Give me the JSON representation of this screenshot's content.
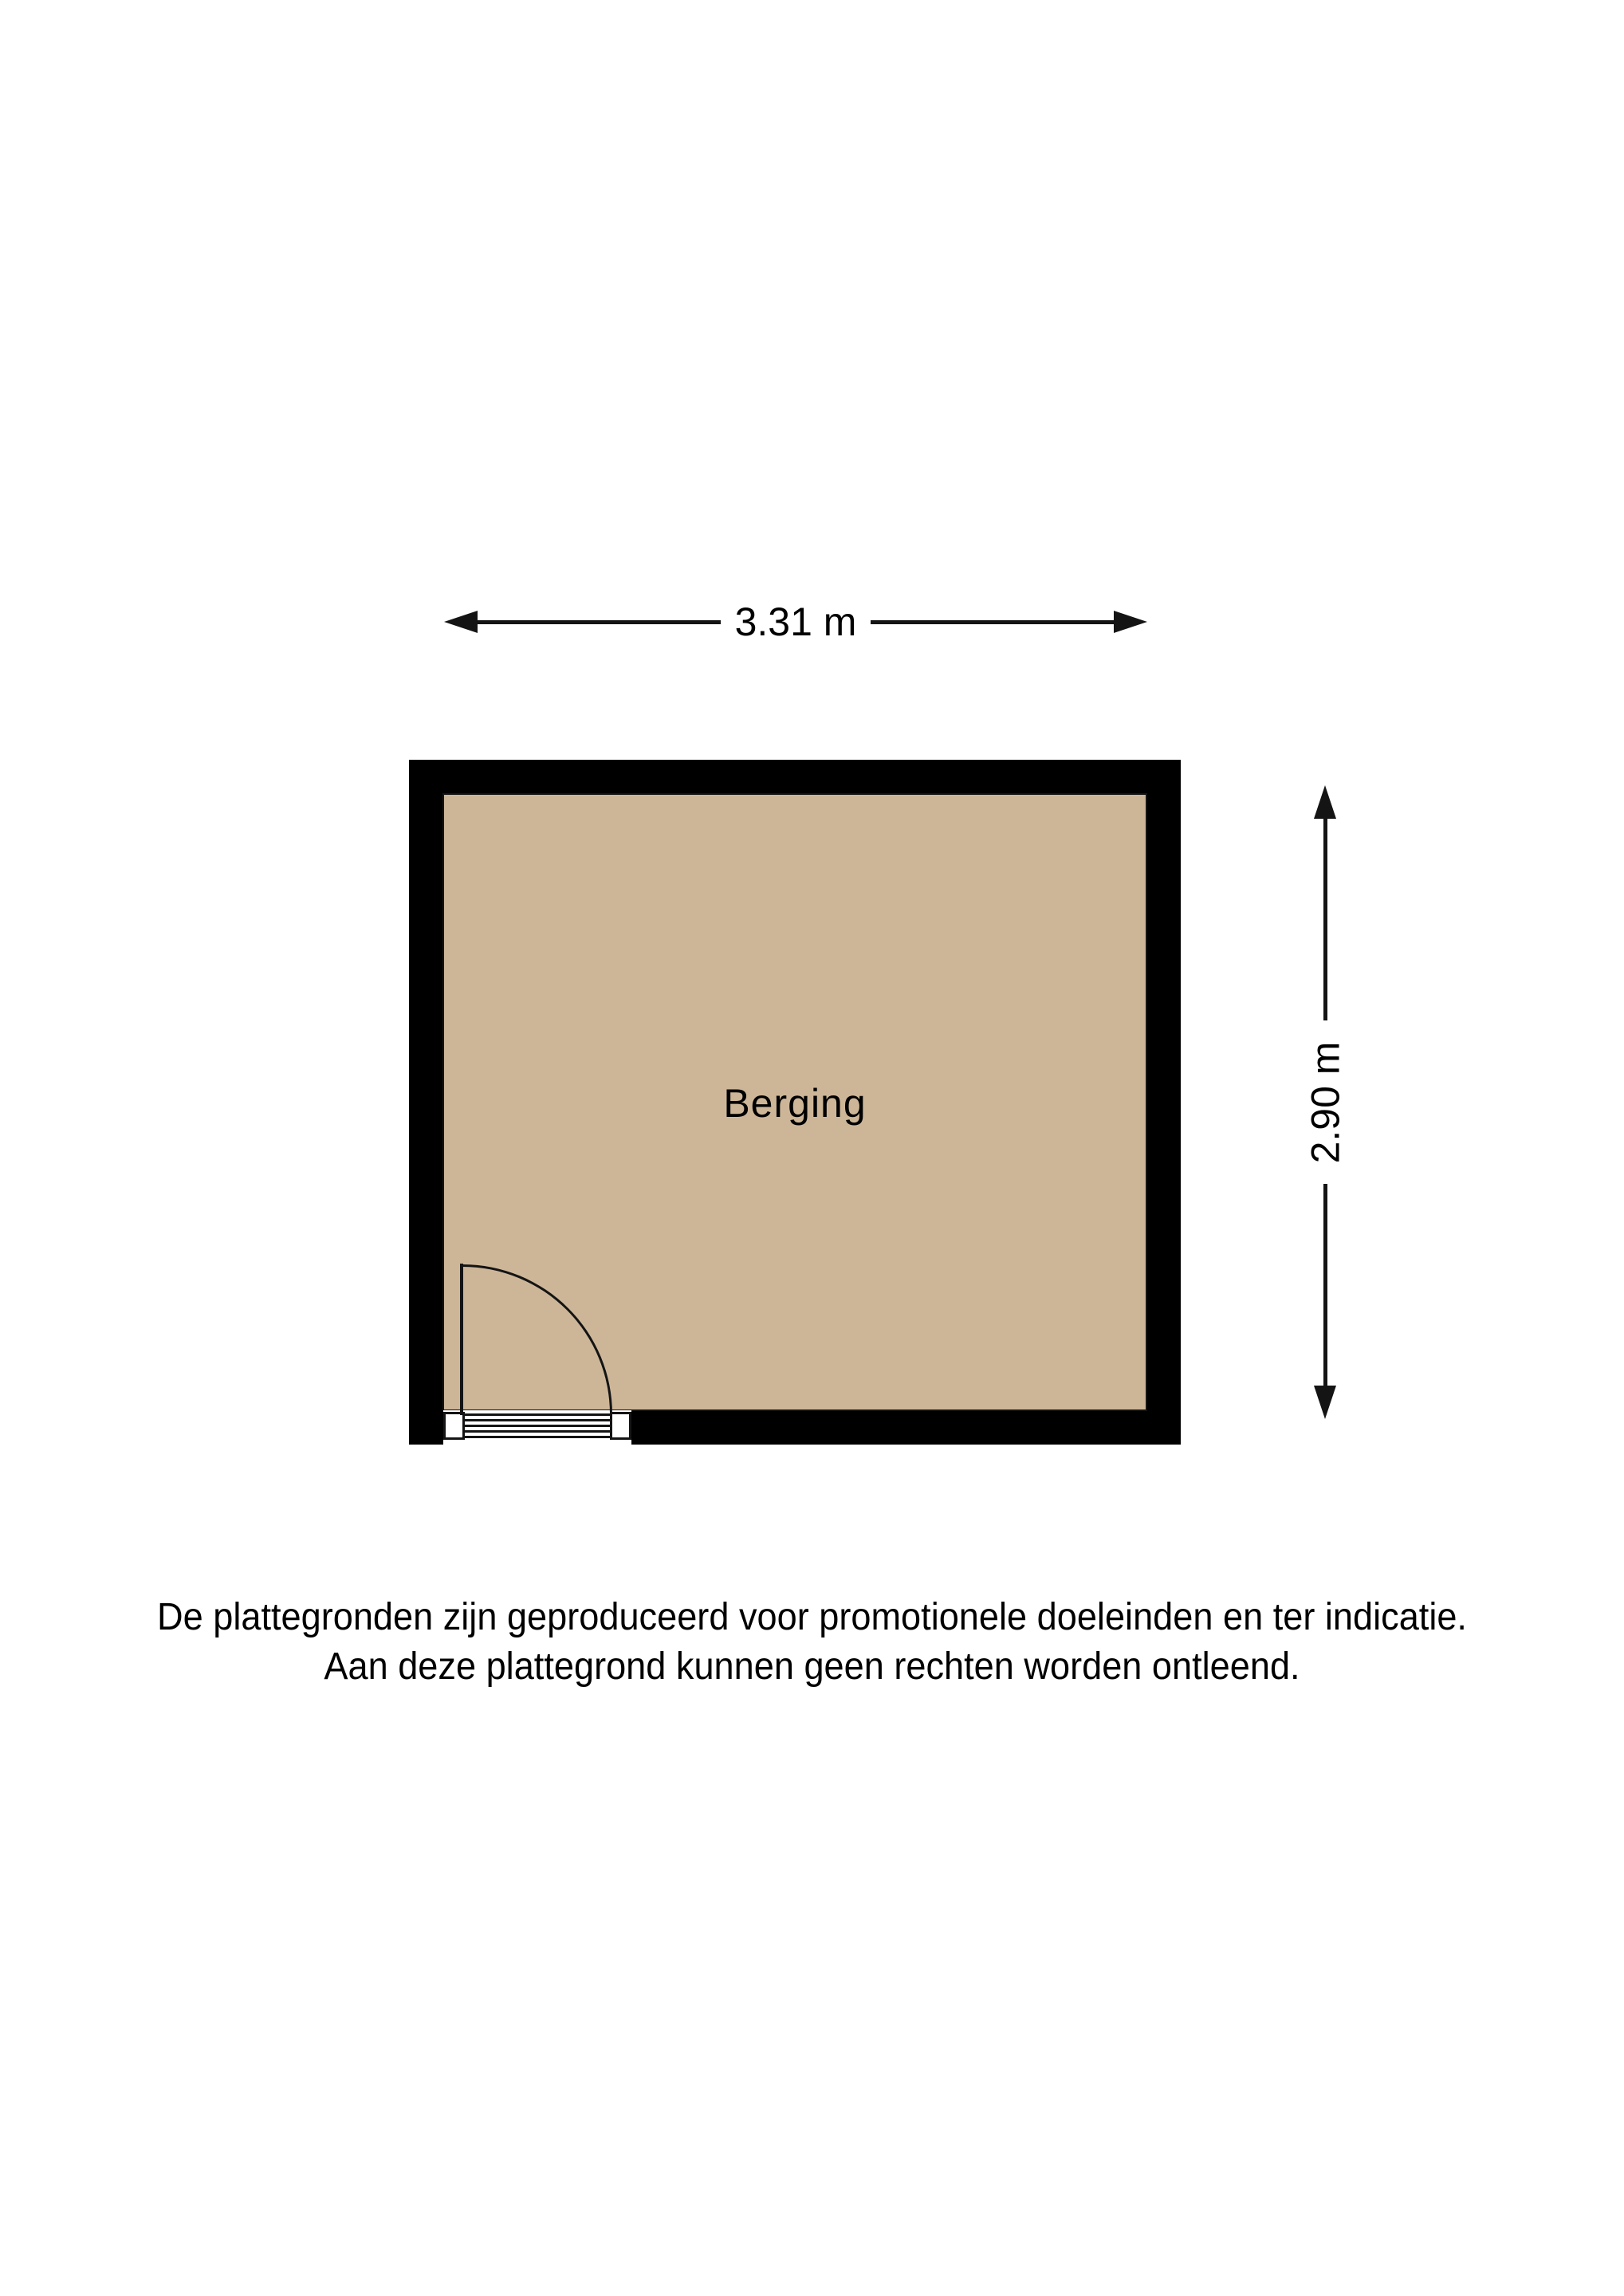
{
  "floorplan": {
    "room": {
      "label": "Berging"
    },
    "dimensions": {
      "width_label": "3.31 m",
      "height_label": "2.90 m"
    },
    "disclaimer": {
      "line1": "De plattegronden zijn geproduceerd voor promotionele doeleinden en ter indicatie.",
      "line2": "Aan deze plattegrond kunnen geen rechten worden ontleend."
    },
    "colors": {
      "wall": "#000000",
      "floor": "#cdb698",
      "line": "#141414",
      "background": "#ffffff"
    }
  }
}
